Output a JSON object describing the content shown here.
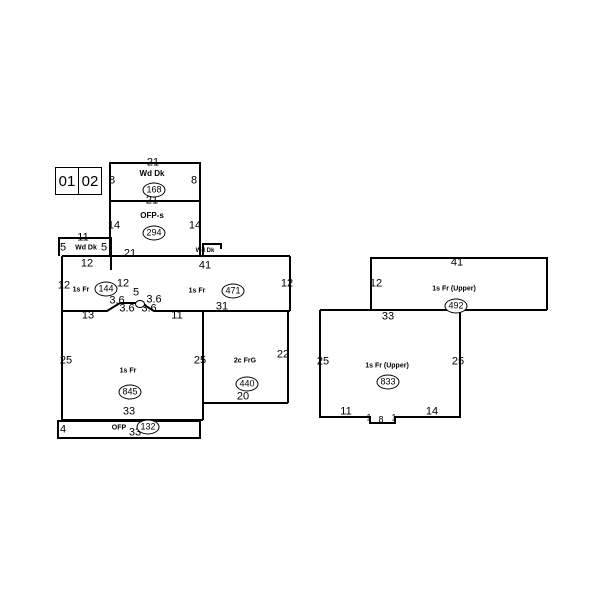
{
  "colors": {
    "wall": "#000000",
    "background": "#ffffff"
  },
  "region_box": {
    "cells": [
      "01",
      "02"
    ]
  },
  "sketch": {
    "labels": [
      {
        "n": "dim-topdeck-top",
        "t": "21",
        "x": 153,
        "y": 163
      },
      {
        "n": "dim-topdeck-left",
        "t": "8",
        "x": 112,
        "y": 181
      },
      {
        "n": "dim-topdeck-right",
        "t": "8",
        "x": 194,
        "y": 181
      },
      {
        "n": "use-topdeck",
        "t": "Wd Dk",
        "x": 152,
        "y": 174,
        "fs": 8,
        "b": 1
      },
      {
        "n": "dim-topdeck-bottom",
        "t": "21",
        "x": 152,
        "y": 201
      },
      {
        "n": "dim-ofps-left",
        "t": "14",
        "x": 114,
        "y": 226
      },
      {
        "n": "dim-ofps-right",
        "t": "14",
        "x": 195,
        "y": 226
      },
      {
        "n": "use-ofps",
        "t": "OFP-s",
        "x": 152,
        "y": 216,
        "fs": 8,
        "b": 1
      },
      {
        "n": "dim-leftdeck-top",
        "t": "11",
        "x": 83,
        "y": 238
      },
      {
        "n": "dim-leftdeck-left",
        "t": "5",
        "x": 63,
        "y": 248
      },
      {
        "n": "use-leftdeck",
        "t": "Wd Dk",
        "x": 86,
        "y": 248,
        "fs": 7,
        "b": 1
      },
      {
        "n": "dim-leftdeck-right",
        "t": "5",
        "x": 104,
        "y": 248
      },
      {
        "n": "dim-main-top-21",
        "t": "21",
        "x": 130,
        "y": 254
      },
      {
        "n": "use-tinydeck",
        "t": "Wd Dk",
        "x": 205,
        "y": 251,
        "fs": 6,
        "b": 1
      },
      {
        "n": "dim-main-top-41",
        "t": "41",
        "x": 205,
        "y": 266
      },
      {
        "n": "dim-main-top-12",
        "t": "12",
        "x": 87,
        "y": 264
      },
      {
        "n": "dim-144-left",
        "t": "12",
        "x": 64,
        "y": 286
      },
      {
        "n": "use-144",
        "t": "1s Fr",
        "x": 81,
        "y": 290,
        "fs": 7,
        "b": 1
      },
      {
        "n": "dim-144-right",
        "t": "12",
        "x": 123,
        "y": 284
      },
      {
        "n": "dim-bay-top",
        "t": "5",
        "x": 136,
        "y": 293
      },
      {
        "n": "dim-bay-upper-left",
        "t": "3.6",
        "x": 117,
        "y": 301
      },
      {
        "n": "dim-bay-upper-right",
        "t": "3.6",
        "x": 154,
        "y": 300
      },
      {
        "n": "dim-bay-lower-left",
        "t": "3.6",
        "x": 127,
        "y": 309
      },
      {
        "n": "dim-bay-lower-right",
        "t": "3.6",
        "x": 149,
        "y": 309
      },
      {
        "n": "dim-845-top-13",
        "t": "13",
        "x": 88,
        "y": 316
      },
      {
        "n": "dim-845-top-11",
        "t": "11",
        "x": 177,
        "y": 316
      },
      {
        "n": "use-471",
        "t": "1s Fr",
        "x": 197,
        "y": 291,
        "fs": 7,
        "b": 1
      },
      {
        "n": "dim-471-right",
        "t": "12",
        "x": 287,
        "y": 284
      },
      {
        "n": "dim-471-bottom",
        "t": "31",
        "x": 222,
        "y": 307
      },
      {
        "n": "dim-845-left",
        "t": "25",
        "x": 66,
        "y": 361
      },
      {
        "n": "dim-845-right",
        "t": "25",
        "x": 200,
        "y": 361
      },
      {
        "n": "use-845",
        "t": "1s Fr",
        "x": 128,
        "y": 371,
        "fs": 7,
        "b": 1
      },
      {
        "n": "dim-845-bottom",
        "t": "33",
        "x": 129,
        "y": 412
      },
      {
        "n": "dim-ofp-left",
        "t": "4",
        "x": 63,
        "y": 430
      },
      {
        "n": "use-ofp",
        "t": "OFP",
        "x": 119,
        "y": 428,
        "fs": 7,
        "b": 1
      },
      {
        "n": "dim-ofp-bottom",
        "t": "33",
        "x": 135,
        "y": 433
      },
      {
        "n": "use-garage",
        "t": "2c FrG",
        "x": 245,
        "y": 361,
        "fs": 7,
        "b": 1
      },
      {
        "n": "dim-garage-right",
        "t": "22",
        "x": 283,
        "y": 355
      },
      {
        "n": "dim-garage-bottom",
        "t": "20",
        "x": 243,
        "y": 397
      },
      {
        "n": "dim-r1-top",
        "t": "41",
        "x": 457,
        "y": 263
      },
      {
        "n": "dim-r1-left",
        "t": "12",
        "x": 376,
        "y": 284
      },
      {
        "n": "use-r1",
        "t": "1s Fr (Upper)",
        "x": 454,
        "y": 289,
        "fs": 7,
        "b": 1
      },
      {
        "n": "dim-r2-top",
        "t": "33",
        "x": 388,
        "y": 317
      },
      {
        "n": "dim-r2-left",
        "t": "25",
        "x": 323,
        "y": 362
      },
      {
        "n": "dim-r2-right",
        "t": "25",
        "x": 458,
        "y": 362
      },
      {
        "n": "use-r2",
        "t": "1s Fr (Upper)",
        "x": 387,
        "y": 366,
        "fs": 7,
        "b": 1
      },
      {
        "n": "dim-r2-bottom-11",
        "t": "11",
        "x": 346,
        "y": 412
      },
      {
        "n": "dim-r2-notch-left",
        "t": "1",
        "x": 369,
        "y": 418,
        "fs": 9
      },
      {
        "n": "dim-r2-notch-bottom",
        "t": "8",
        "x": 381,
        "y": 420,
        "fs": 9
      },
      {
        "n": "dim-r2-notch-right",
        "t": "1",
        "x": 394,
        "y": 418,
        "fs": 9
      },
      {
        "n": "dim-r2-bottom-14",
        "t": "14",
        "x": 432,
        "y": 412
      }
    ],
    "bubbles": [
      {
        "n": "area-topdeck",
        "t": "168",
        "x": 154,
        "y": 190
      },
      {
        "n": "area-ofps",
        "t": "294",
        "x": 154,
        "y": 233
      },
      {
        "n": "area-144",
        "t": "144",
        "x": 106,
        "y": 289
      },
      {
        "n": "area-471",
        "t": "471",
        "x": 233,
        "y": 291
      },
      {
        "n": "area-845",
        "t": "845",
        "x": 130,
        "y": 392
      },
      {
        "n": "area-440",
        "t": "440",
        "x": 247,
        "y": 384
      },
      {
        "n": "area-132",
        "t": "132",
        "x": 148,
        "y": 427
      },
      {
        "n": "area-492",
        "t": "492",
        "x": 456,
        "y": 306
      },
      {
        "n": "area-833",
        "t": "833",
        "x": 388,
        "y": 382
      },
      {
        "n": "bay-area-circle",
        "t": "",
        "x": 140,
        "y": 304,
        "tiny": 1
      }
    ]
  }
}
